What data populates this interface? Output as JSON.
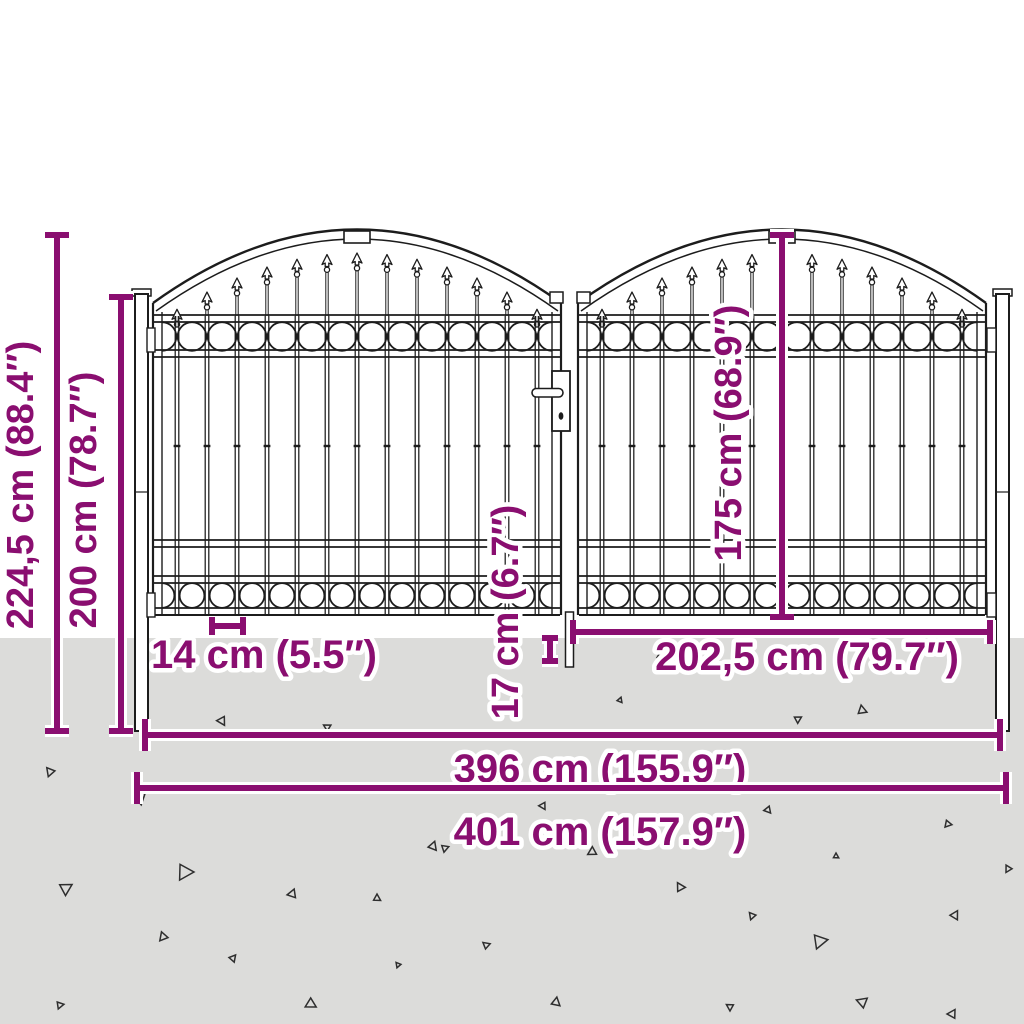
{
  "colors": {
    "accent": "#8a0e70",
    "ground": "#dcdcda",
    "line_art": "#1c1c1c"
  },
  "dims": {
    "total_height": "224,5 cm (88.4″)",
    "gate_height": "200 cm (78.7″)",
    "leaf_height": "175 cm (68.9″)",
    "bottom_clearance": "17 cm (6.7″)",
    "bar_spacing": "14 cm (5.5″)",
    "leaf_width": "202,5 cm (79.7″)",
    "inner_width": "396 cm (155.9″)",
    "total_width": "401 cm (157.9″)"
  }
}
